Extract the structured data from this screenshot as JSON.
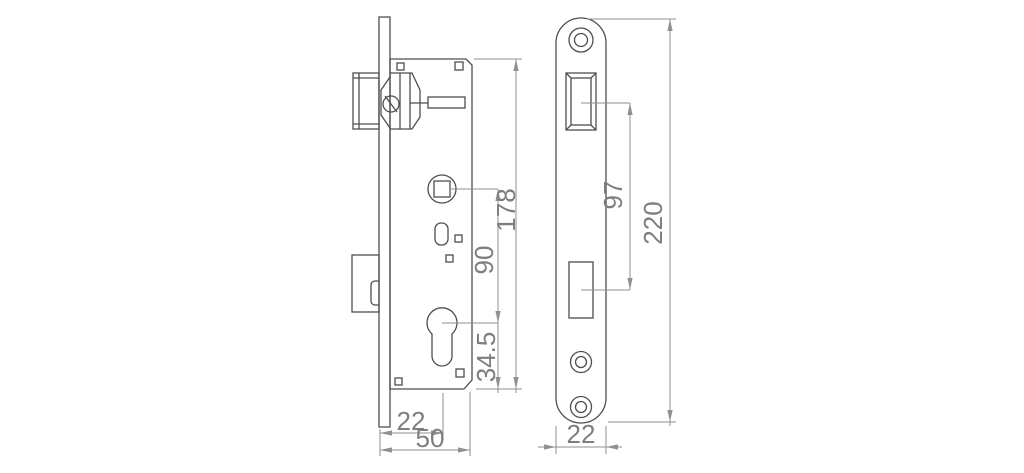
{
  "drawing": {
    "colors": {
      "object_line": "#4e4e4e",
      "dim_line": "#8e9092",
      "dim_text": "#7c7e80",
      "background": "#ffffff"
    },
    "side_view": {
      "dims": {
        "case_height": "178",
        "spindle_to_cylinder": "90",
        "cylinder_to_bottom": "34.5",
        "backset": "22",
        "case_depth": "50"
      }
    },
    "front_view": {
      "dims": {
        "lock_centers": "97",
        "plate_height": "220",
        "plate_width": "22"
      }
    }
  }
}
